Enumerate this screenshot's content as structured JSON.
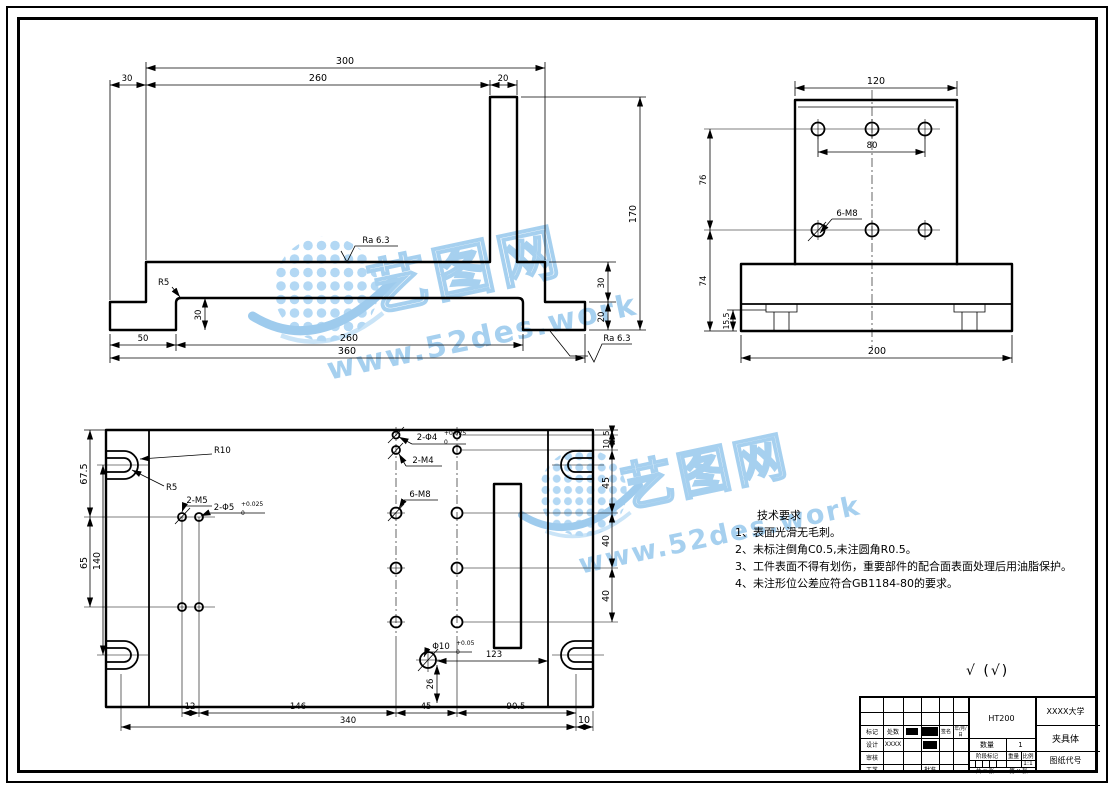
{
  "watermark": {
    "brand": "艺图网",
    "site": "www.52des.work",
    "color": "#a6d0ef"
  },
  "surface_note": {
    "check": "√",
    "paren": "(√)"
  },
  "front_view": {
    "dim_300": "300",
    "dim_30_top": "30",
    "dim_260_top": "260",
    "dim_20_top": "20",
    "dim_170": "170",
    "dim_30_right": "30",
    "dim_20_right": "20",
    "label_r5": "R5",
    "dim_30_inner": "30",
    "dim_50": "50",
    "dim_260_bottom": "260",
    "dim_360": "360",
    "ra_top": "Ra 6.3",
    "ra_bottom": "Ra 6.3"
  },
  "side_view": {
    "dim_120": "120",
    "dim_80": "80",
    "dim_76": "76",
    "dim_74": "74",
    "dim_15_5": "15.5",
    "dim_200": "200",
    "label_holes": "6-M8"
  },
  "plan_view": {
    "dim_67_5": "67.5",
    "dim_140": "140",
    "dim_65": "65",
    "label_r10": "R10",
    "label_r5": "R5",
    "label_2m5": "2-M5",
    "label_2d5": "2-Φ5",
    "tol_2d5_sup": "+0.025",
    "tol_2d5_sub": "0",
    "label_2d4": "2-Φ4",
    "tol_2d4_sup": "+0.025",
    "tol_2d4_sub": "0",
    "label_2m4": "2-M4",
    "label_6m8": "6-M8",
    "label_d10": "Φ10",
    "tol_d10_sup": "+0.05",
    "tol_d10_sub": "0",
    "dim_123": "123",
    "dim_26": "26",
    "dim_5": "5",
    "dim_10_right": "10",
    "dim_45_right": "45",
    "dim_40_a": "40",
    "dim_40_b": "40",
    "dim_12": "12",
    "dim_146": "146",
    "dim_45_bottom": "45",
    "dim_90_5": "90.5",
    "dim_340": "340",
    "dim_10_bottom": "10"
  },
  "tech_req": {
    "title": "技术要求",
    "items": [
      "1、表面光滑无毛刺。",
      "2、未标注倒角C0.5,未注圆角R0.5。",
      "3、工件表面不得有划伤，重要部件的配合面表面处理后用油脂保护。",
      "4、未注形位公差应符合GB1184-80的要求。"
    ]
  },
  "title_block": {
    "material": "HT200",
    "company": "XXXX大学",
    "part_name": "夹具体",
    "drawing_no": "图纸代号",
    "qty_label": "数量",
    "qty_value": "1",
    "stage_label": "阶段标记",
    "weight_label": "重量",
    "scale_label": "比例",
    "scale_value": "1:1",
    "sheets": "共 X 张",
    "sheet_no": "第 X 张",
    "col_mark": "标记",
    "col_count": "处数",
    "col_sign": "签名",
    "col_date": "年/月/日",
    "row_design": "设计",
    "design_name": "XXXX",
    "row_check": "审核",
    "row_process": "工艺",
    "cell_approve": "批准"
  }
}
